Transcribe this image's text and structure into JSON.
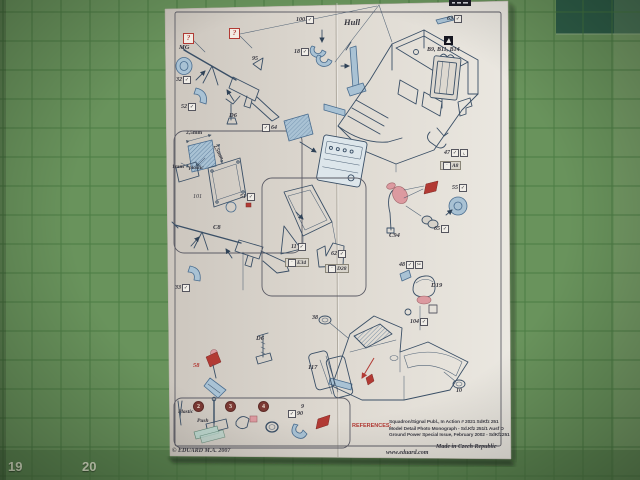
{
  "colors": {
    "mat_green": "#69935c",
    "mat_grid": "#45773f",
    "mat_dark": "#2e5e48",
    "ink": "#3a4f66",
    "pe_fill": "#a9c2d4",
    "pe_stroke": "#4a6d8f",
    "red": "#b23a34",
    "pink": "#dc9aa0",
    "gray_box": "#d8d4cb",
    "label": "#36363f"
  },
  "mat": {
    "ruler_numbers": {
      "left": "19",
      "right": "20"
    }
  },
  "sheet": {
    "references": {
      "title": "REFERENCES:",
      "lines": [
        "Squadron/Signal Publ., In Action # 2021 SdKfz 251",
        "Model Detail Photo Monograph  - Sd.Kfz 251/1 Ausf D",
        "Ground Power Special Issue, February 2002 - SdKfz251"
      ]
    },
    "footer": {
      "copyright": "© EDUARD  M.A. 2007",
      "website": "www.eduard.com",
      "made_in": "Made in Czech Republic"
    }
  },
  "labels": [
    {
      "text": "?",
      "style": "q",
      "x": 183,
      "y": 33,
      "name": "question-box"
    },
    {
      "text": "?",
      "style": "q",
      "x": 229,
      "y": 28,
      "name": "question-box"
    },
    {
      "text": "MG",
      "style": "name",
      "x": 179,
      "y": 44
    },
    {
      "text": "32",
      "style": "num",
      "x": 176,
      "y": 76,
      "icons": [
        "check"
      ]
    },
    {
      "text": "52",
      "style": "num",
      "x": 181,
      "y": 103,
      "icons": [
        "check"
      ]
    },
    {
      "text": "95",
      "style": "num",
      "x": 252,
      "y": 56
    },
    {
      "text": "D6",
      "style": "name",
      "x": 229,
      "y": 112
    },
    {
      "text": "100",
      "style": "num",
      "x": 296,
      "y": 16,
      "icons": [
        "check"
      ]
    },
    {
      "text": "18",
      "style": "num",
      "x": 294,
      "y": 48,
      "icons": [
        "check"
      ]
    },
    {
      "text": "Hull",
      "style": "big",
      "x": 344,
      "y": 17
    },
    {
      "text": "63",
      "style": "num",
      "x": 447,
      "y": 15,
      "icons": [
        "check"
      ]
    },
    {
      "text": "B9, B11, B14",
      "style": "bname",
      "x": 427,
      "y": 47
    },
    {
      "text": "64",
      "style": "num",
      "x": 262,
      "y": 124,
      "icons": [
        "check"
      ],
      "pre": true
    },
    {
      "text": "2,5mm",
      "style": "mm",
      "x": 186,
      "y": 130
    },
    {
      "text": "2,5mm",
      "style": "mm",
      "x": 217,
      "y": 144,
      "rot": 62
    },
    {
      "text": "1mm",
      "style": "mm",
      "x": 172,
      "y": 164
    },
    {
      "text": "plastic",
      "style": "mmi",
      "x": 189,
      "y": 165
    },
    {
      "text": "101",
      "style": "numi",
      "x": 193,
      "y": 194
    },
    {
      "text": "51",
      "style": "num",
      "x": 240,
      "y": 193,
      "icons": [
        "check"
      ]
    },
    {
      "text": "C8",
      "style": "name",
      "x": 213,
      "y": 224
    },
    {
      "text": "33",
      "style": "num",
      "x": 175,
      "y": 284,
      "icons": [
        "check"
      ]
    },
    {
      "text": "11",
      "style": "num",
      "x": 291,
      "y": 243,
      "icons": [
        "check"
      ]
    },
    {
      "text": "E34",
      "style": "gbox",
      "x": 285,
      "y": 258,
      "icons": [
        "dot"
      ],
      "pre": true
    },
    {
      "text": "62",
      "style": "num",
      "x": 331,
      "y": 250,
      "icons": [
        "check"
      ]
    },
    {
      "text": "D28",
      "style": "gbox",
      "x": 325,
      "y": 264,
      "icons": [
        "dot"
      ],
      "pre": true
    },
    {
      "text": "C94",
      "style": "name",
      "x": 389,
      "y": 232
    },
    {
      "text": "55",
      "style": "num",
      "x": 452,
      "y": 184,
      "icons": [
        "check"
      ]
    },
    {
      "text": "65",
      "style": "num",
      "x": 434,
      "y": 225,
      "icons": [
        "check"
      ]
    },
    {
      "text": "48",
      "style": "num",
      "x": 399,
      "y": 261,
      "icons": [
        "check",
        "scissors"
      ]
    },
    {
      "text": "D19",
      "style": "name",
      "x": 431,
      "y": 282
    },
    {
      "text": "104",
      "style": "num",
      "x": 410,
      "y": 318,
      "icons": [
        "check"
      ]
    },
    {
      "text": "47",
      "style": "num",
      "x": 444,
      "y": 149,
      "icons": [
        "check",
        "bend"
      ]
    },
    {
      "text": "A8",
      "style": "gbox",
      "x": 440,
      "y": 161,
      "icons": [
        "dot"
      ],
      "pre": true
    },
    {
      "text": "38",
      "style": "num",
      "x": 312,
      "y": 315
    },
    {
      "text": "117",
      "style": "name",
      "x": 308,
      "y": 364
    },
    {
      "text": "10",
      "style": "num",
      "x": 456,
      "y": 388
    },
    {
      "text": "58",
      "style": "redname",
      "x": 193,
      "y": 362
    },
    {
      "text": "D6",
      "style": "name",
      "x": 256,
      "y": 335
    },
    {
      "text": "9",
      "style": "num",
      "x": 301,
      "y": 404
    },
    {
      "text": "90",
      "style": "num",
      "x": 288,
      "y": 410,
      "icons": [
        "check"
      ],
      "pre": true
    },
    {
      "text": "2",
      "style": "circle",
      "x": 193,
      "y": 401
    },
    {
      "text": "3",
      "style": "circle",
      "x": 225,
      "y": 401
    },
    {
      "text": "4",
      "style": "circle",
      "x": 258,
      "y": 401
    },
    {
      "text": "Plastic",
      "style": "mmi",
      "x": 178,
      "y": 409
    },
    {
      "text": "Push",
      "style": "mmi",
      "x": 197,
      "y": 418
    }
  ]
}
